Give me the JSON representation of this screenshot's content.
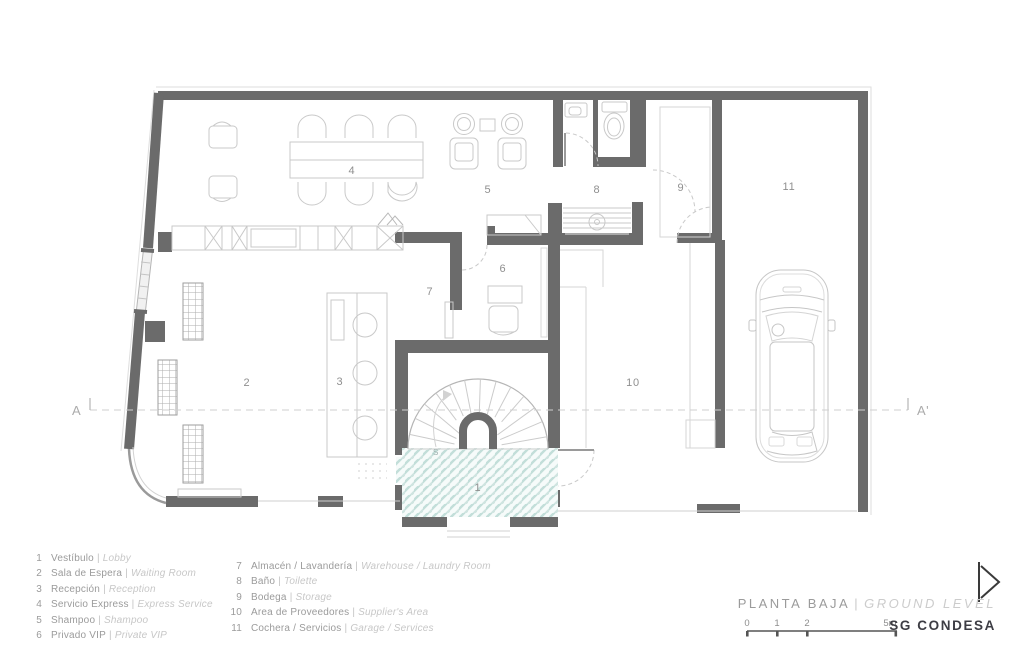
{
  "title_block": {
    "plan_title_es": "PLANTA BAJA",
    "separator": "|",
    "plan_title_en": "GROUND LEVEL",
    "brand": "SG CONDESA"
  },
  "scale_bar": {
    "labels": [
      "0",
      "1",
      "2",
      "5m"
    ]
  },
  "section_line": {
    "start_label": "A",
    "end_label": "A'"
  },
  "legend": {
    "separator": "|",
    "items": [
      {
        "num": "1",
        "es": "Vestíbulo",
        "en": "Lobby"
      },
      {
        "num": "2",
        "es": "Sala de Espera",
        "en": "Waiting Room"
      },
      {
        "num": "3",
        "es": "Recepción",
        "en": "Reception"
      },
      {
        "num": "4",
        "es": "Servicio Express",
        "en": "Express Service"
      },
      {
        "num": "5",
        "es": "Shampoo",
        "en": "Shampoo"
      },
      {
        "num": "6",
        "es": "Privado VIP",
        "en": "Private VIP"
      },
      {
        "num": "7",
        "es": "Almacén / Lavandería",
        "en": "Warehouse / Laundry Room"
      },
      {
        "num": "8",
        "es": "Baño",
        "en": "Toilette"
      },
      {
        "num": "9",
        "es": "Bodega",
        "en": "Storage"
      },
      {
        "num": "10",
        "es": "Area de Proveedores",
        "en": "Supplier's Area"
      },
      {
        "num": "11",
        "es": "Cochera / Servicios",
        "en": "Garage / Services"
      }
    ]
  },
  "plan": {
    "stair_direction_label": "S",
    "room_labels": [
      {
        "n": "1"
      },
      {
        "n": "2"
      },
      {
        "n": "3"
      },
      {
        "n": "4"
      },
      {
        "n": "5"
      },
      {
        "n": "6"
      },
      {
        "n": "7"
      },
      {
        "n": "8"
      },
      {
        "n": "9"
      },
      {
        "n": "10"
      },
      {
        "n": "11"
      }
    ],
    "colors": {
      "wall": "#6b6b6b",
      "furniture_line": "#c9c9c9",
      "tile_teal": "#c2ded9",
      "brand_text": "#3d3d44"
    }
  }
}
